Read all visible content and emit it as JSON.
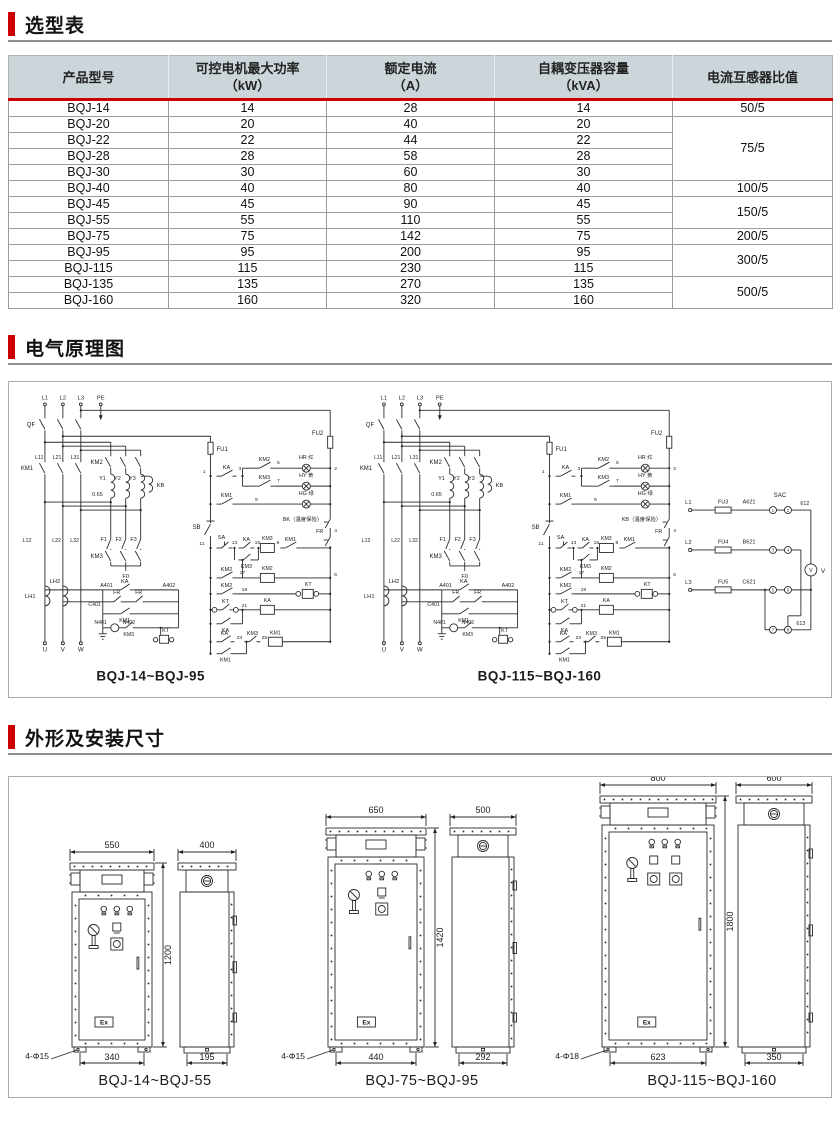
{
  "sections": {
    "selection": {
      "title": "选型表"
    },
    "schematic": {
      "title": "电气原理图"
    },
    "dimensions": {
      "title": "外形及安装尺寸"
    }
  },
  "table": {
    "headers": [
      {
        "line1": "产品型号",
        "line2": ""
      },
      {
        "line1": "可控电机最大功率",
        "line2": "（kW）"
      },
      {
        "line1": "额定电流",
        "line2": "（A）"
      },
      {
        "line1": "自耦变压器容量",
        "line2": "（kVA）"
      },
      {
        "line1": "电流互感器比值",
        "line2": ""
      }
    ],
    "rows": [
      {
        "model": "BQJ-14",
        "power": "14",
        "current": "28",
        "capacity": "14"
      },
      {
        "model": "BQJ-20",
        "power": "20",
        "current": "40",
        "capacity": "20"
      },
      {
        "model": "BQJ-22",
        "power": "22",
        "current": "44",
        "capacity": "22"
      },
      {
        "model": "BQJ-28",
        "power": "28",
        "current": "58",
        "capacity": "28"
      },
      {
        "model": "BQJ-30",
        "power": "30",
        "current": "60",
        "capacity": "30"
      },
      {
        "model": "BQJ-40",
        "power": "40",
        "current": "80",
        "capacity": "40"
      },
      {
        "model": "BQJ-45",
        "power": "45",
        "current": "90",
        "capacity": "45"
      },
      {
        "model": "BQJ-55",
        "power": "55",
        "current": "110",
        "capacity": "55"
      },
      {
        "model": "BQJ-75",
        "power": "75",
        "current": "142",
        "capacity": "75"
      },
      {
        "model": "BQJ-95",
        "power": "95",
        "current": "200",
        "capacity": "95"
      },
      {
        "model": "BQJ-115",
        "power": "115",
        "current": "230",
        "capacity": "115"
      },
      {
        "model": "BQJ-135",
        "power": "135",
        "current": "270",
        "capacity": "135"
      },
      {
        "model": "BQJ-160",
        "power": "160",
        "current": "320",
        "capacity": "160"
      }
    ],
    "ratio_groups": [
      {
        "value": "50/5",
        "span": 1
      },
      {
        "value": "75/5",
        "span": 4
      },
      {
        "value": "100/5",
        "span": 1
      },
      {
        "value": "150/5",
        "span": 2
      },
      {
        "value": "200/5",
        "span": 1
      },
      {
        "value": "300/5",
        "span": 2
      },
      {
        "value": "500/5",
        "span": 2
      }
    ]
  },
  "schematic": {
    "left_caption": "BQJ-14~BQJ-95",
    "right_caption": "BQJ-115~BQJ-160",
    "left_thermal": "BK（温度保险）",
    "right_thermal": "KB（温度保险）",
    "phases": [
      "L1",
      "L2",
      "L3",
      "PE"
    ],
    "breaker": "QF",
    "bus1": [
      "L11",
      "L21",
      "L31"
    ],
    "bus2": [
      "L12",
      "L22",
      "L32"
    ],
    "km1": "KM1",
    "km2": "KM2",
    "km3": "KM3",
    "windings": [
      "Y1",
      "Y2",
      "Y3"
    ],
    "tap": "0.65",
    "kb": "KB",
    "fuses": [
      "F1",
      "F2",
      "F3"
    ],
    "f0": "F0",
    "a401": "A401",
    "a402": "A402",
    "c401": "C401",
    "n401": "N401",
    "n402": "N402",
    "ka": "KA",
    "fr": "FR",
    "kt": "KT",
    "lh1": "LH1",
    "lh2": "LH2",
    "outputs": [
      "U",
      "V",
      "W"
    ],
    "fu1": "FU1",
    "fu2": "FU2",
    "sb": "SB",
    "sa": "SA",
    "lamps": [
      "HR 红",
      "HY 黄",
      "HG 绿"
    ],
    "nodes": [
      "1",
      "2",
      "3",
      "4",
      "5",
      "6",
      "7",
      "8",
      "9",
      "11",
      "13",
      "15",
      "17",
      "19",
      "21",
      "23",
      "25"
    ],
    "meter": {
      "sac": "SAC",
      "rows": [
        {
          "line": "L1",
          "fuse": "FU3",
          "wire": "A621"
        },
        {
          "line": "L2",
          "fuse": "FU4",
          "wire": "B621"
        },
        {
          "line": "L3",
          "fuse": "FU5",
          "wire": "C621"
        }
      ],
      "top_wire": "612",
      "bottom_wire": "613",
      "voltmeter": "V",
      "circled": [
        "1",
        "2",
        "3",
        "4",
        "5",
        "6",
        "7",
        "8"
      ]
    }
  },
  "cabinets": {
    "ex_mark": "Ex",
    "groups": [
      {
        "caption": "BQJ-14~BQJ-55",
        "front_width": "550",
        "side_width": "400",
        "height": "1200",
        "front_base": "340",
        "side_base": "195",
        "holes": "4-Φ15"
      },
      {
        "caption": "BQJ-75~BQJ-95",
        "front_width": "650",
        "side_width": "500",
        "height": "1420",
        "front_base": "440",
        "side_base": "292",
        "holes": "4-Φ15"
      },
      {
        "caption": "BQJ-115~BQJ-160",
        "front_width": "800",
        "side_width": "600",
        "height": "1800",
        "front_base": "623",
        "side_base": "350",
        "holes": "4-Φ18"
      }
    ]
  }
}
